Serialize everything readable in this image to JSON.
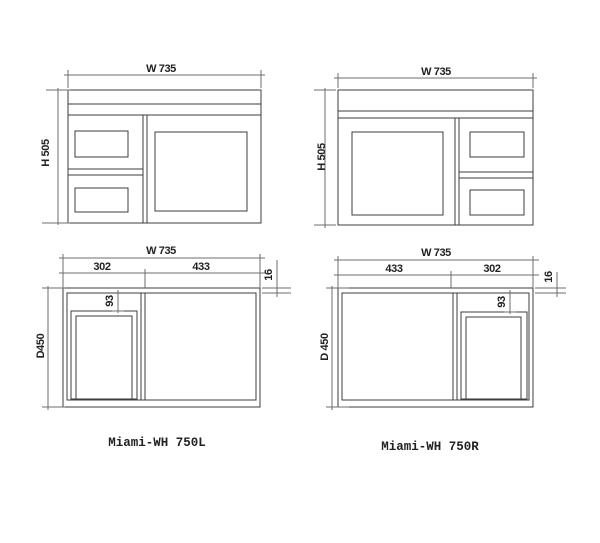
{
  "sheet": {
    "captions": {
      "left": "Miami-WH 750L",
      "right": "Miami-WH 750R"
    }
  },
  "drawings": {
    "front_left": {
      "width_label": "W 735",
      "height_label": "H 505"
    },
    "front_right": {
      "width_label": "W 735",
      "height_label": "H 505"
    },
    "plan_left": {
      "width_label": "W 735",
      "segment_left_label": "302",
      "segment_right_label": "433",
      "drawer_inset_label": "93",
      "panel_thickness_label": "16",
      "depth_label": "D450"
    },
    "plan_right": {
      "width_label": "W 735",
      "segment_left_label": "433",
      "segment_right_label": "302",
      "drawer_inset_label": "93",
      "panel_thickness_label": "16",
      "depth_label": "D 450"
    }
  },
  "colors": {
    "object_line": "#3d3d3d",
    "dimension_line": "#6e6e6e",
    "text": "#222222",
    "background": "#ffffff"
  }
}
